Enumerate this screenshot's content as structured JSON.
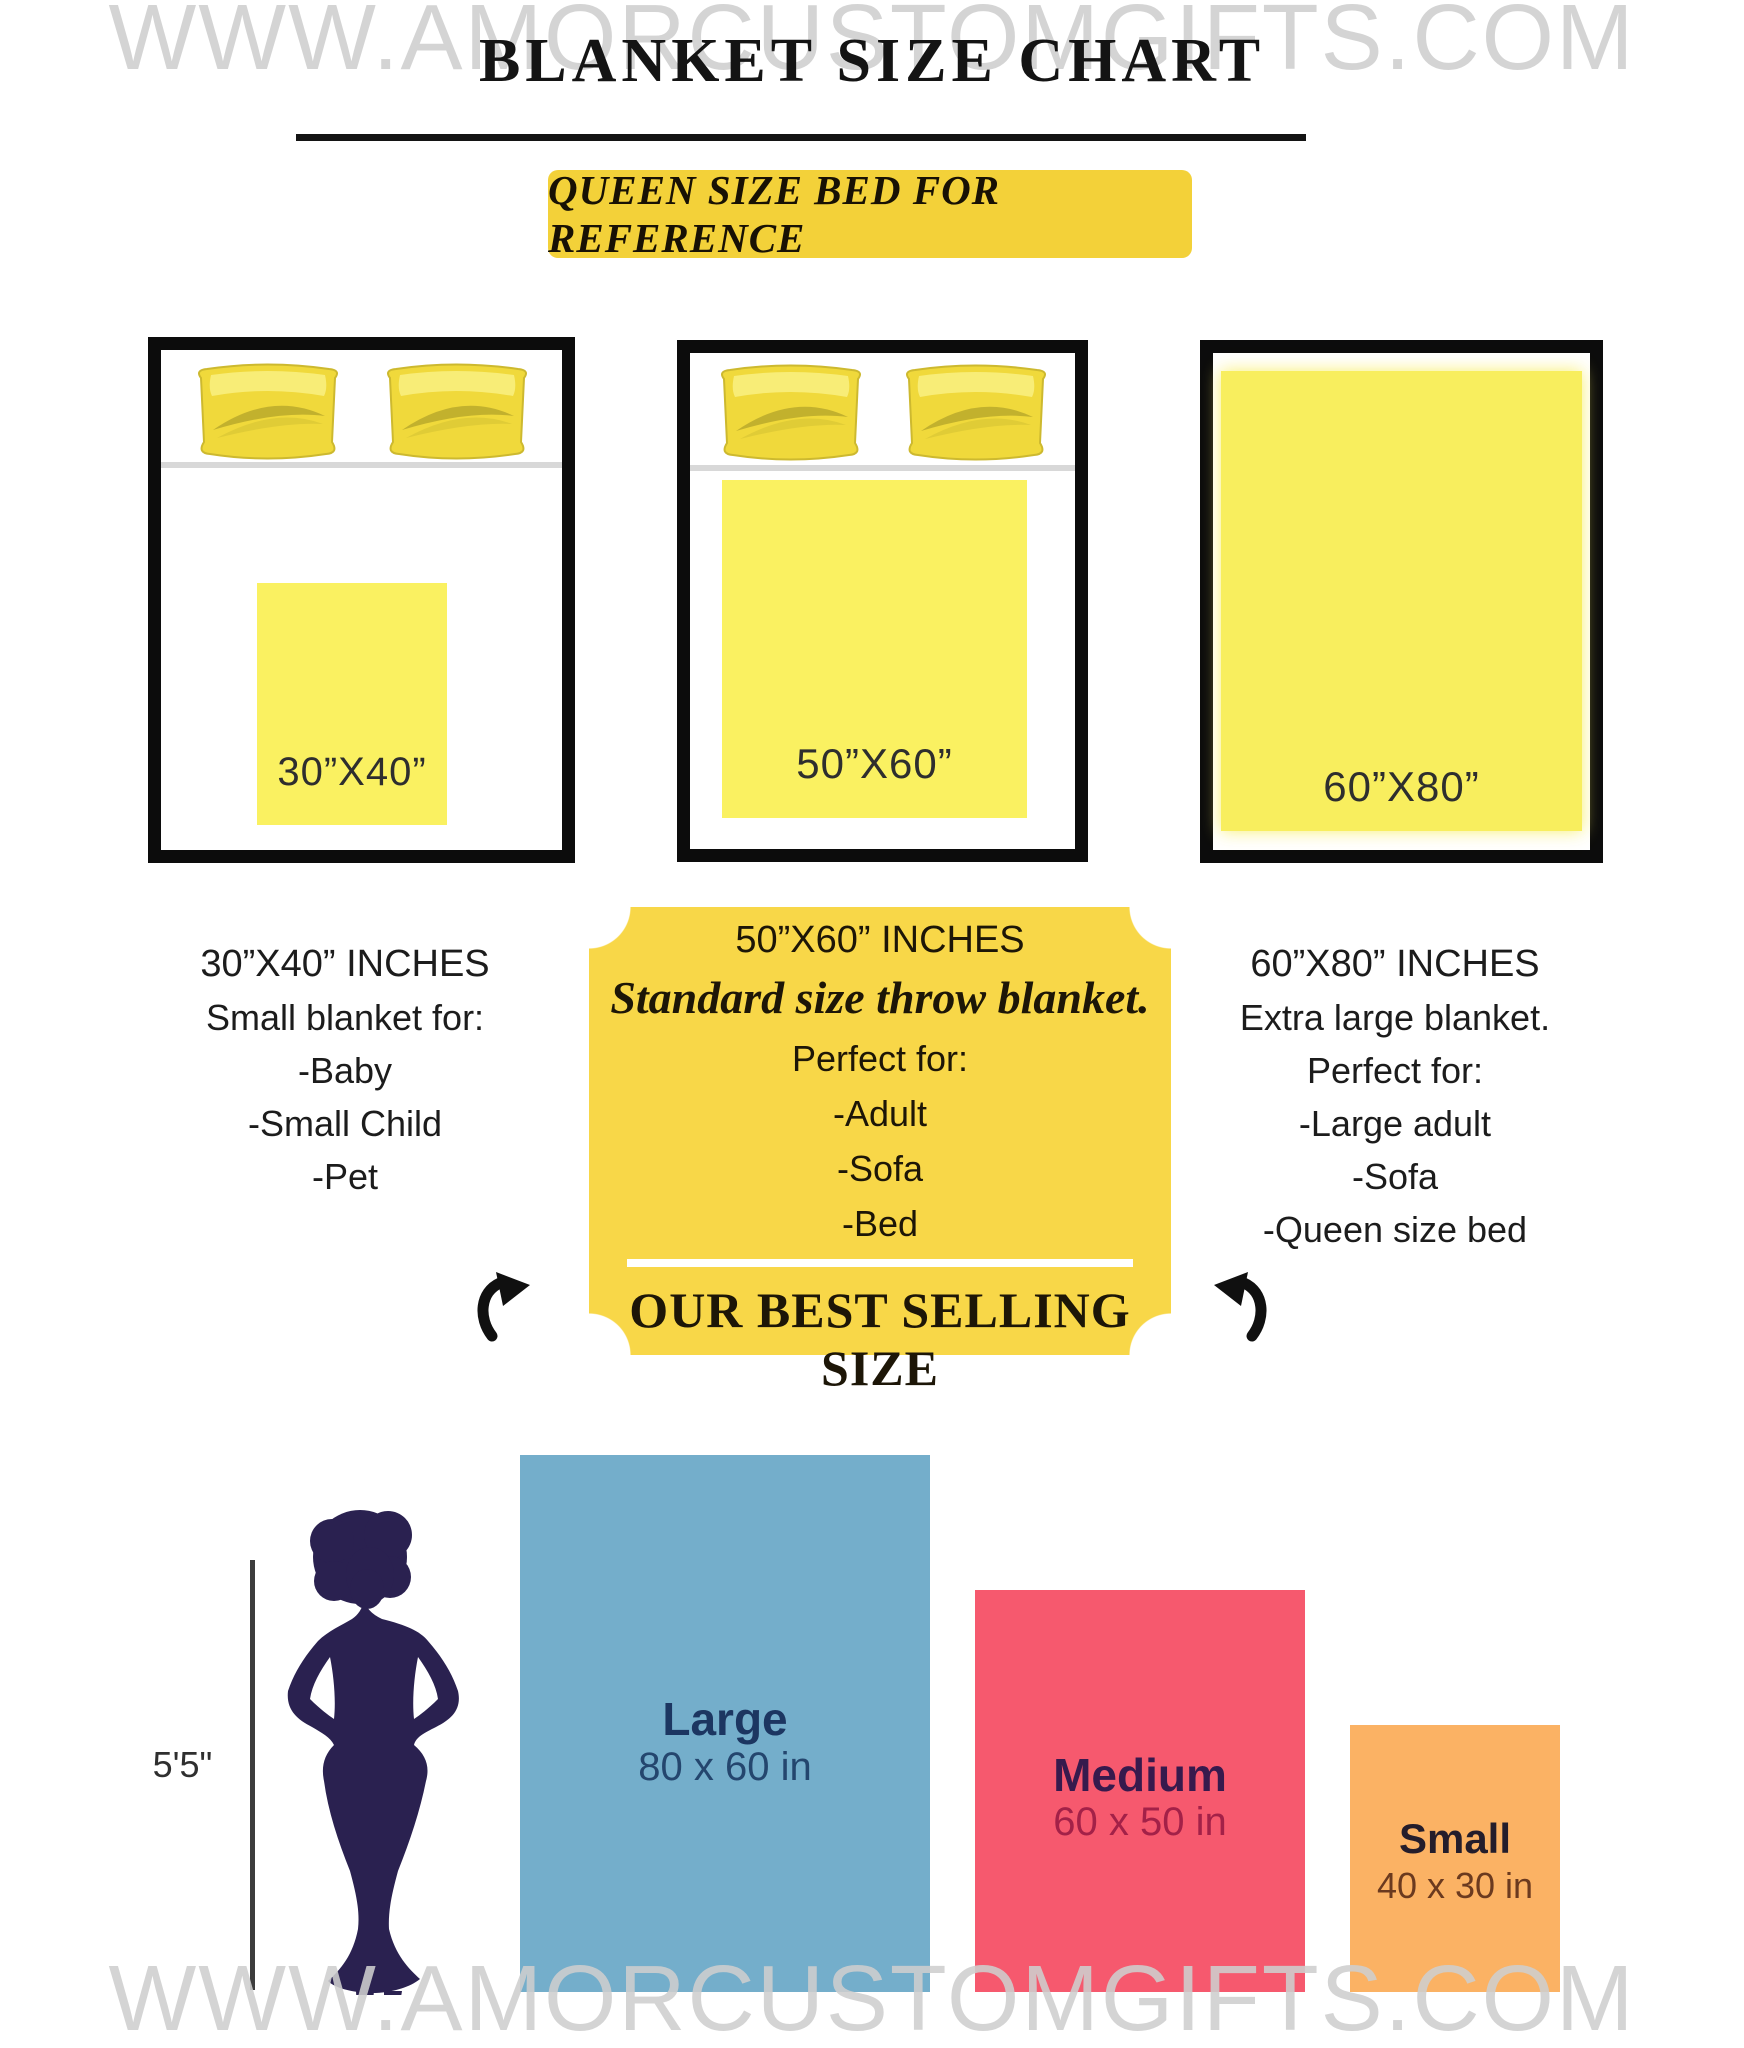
{
  "watermark": {
    "text": "WWW.AMORCUSTOMGIFTS.COM"
  },
  "header": {
    "title": "BLANKET SIZE CHART",
    "banner_label": "QUEEN SIZE BED FOR REFERENCE"
  },
  "beds": [
    {
      "blanket_label": "30”X40”"
    },
    {
      "blanket_label": "50”X60”"
    },
    {
      "blanket_label": "60”X80”"
    }
  ],
  "details": {
    "small": {
      "title": "30”X40” INCHES",
      "subtitle": "Small blanket for:",
      "items": [
        "-Baby",
        "-Small Child",
        "-Pet"
      ]
    },
    "best": {
      "title": "50”X60” INCHES",
      "tagline": "Standard size throw blanket.",
      "perfect_for": "Perfect for:",
      "items": [
        "-Adult",
        "-Sofa",
        "-Bed"
      ],
      "footer": "OUR BEST SELLING SIZE"
    },
    "xl": {
      "title": "60”X80” INCHES",
      "subtitle": "Extra large blanket.",
      "perfect_for": "Perfect for:",
      "items": [
        "-Large adult",
        "-Sofa",
        "-Queen size bed"
      ]
    }
  },
  "comparison": {
    "person_height_label": "5'5\"",
    "bars": [
      {
        "label": "Large",
        "dimensions": "80 x 60 in",
        "color": "#74aecb"
      },
      {
        "label": "Medium",
        "dimensions": "60 x 50 in",
        "color": "#f6596e"
      },
      {
        "label": "Small",
        "dimensions": "40 x 30 in",
        "color": "#fbb264"
      }
    ]
  },
  "palette": {
    "banner_yellow": "#f3d139",
    "badge_yellow": "#f8d748",
    "blanket_yellow": "#faf161",
    "pillow_gold": "#f0d93b",
    "silhouette_navy": "#2a2150",
    "watermark_gray": "#cecece",
    "bed_border_black": "#0c0c0c"
  }
}
